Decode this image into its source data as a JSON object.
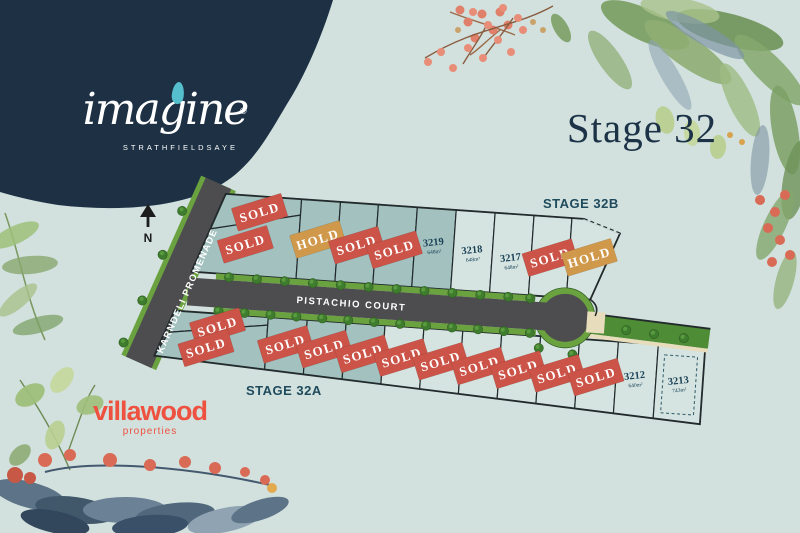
{
  "header": {
    "brand": {
      "name": "imagine",
      "tagline": "STRATHFIELDSAYE",
      "mark": "®"
    },
    "stage_title": "Stage 32"
  },
  "masterplan": {
    "north_label": "N",
    "stage_b_label": "STAGE 32B",
    "stage_a_label": "STAGE 32A",
    "streets": {
      "court": "PISTACHIO COURT",
      "promenade": "KARNDELI  PROMENADE"
    },
    "status_labels": {
      "sold": "SOLD",
      "hold": "HOLD"
    },
    "top_strip": {
      "corner_lots": [
        {
          "status": "sold",
          "tone": "dark"
        },
        {
          "status": "sold",
          "tone": "dark"
        }
      ],
      "lots": [
        {
          "status": "hold",
          "tone": "dark"
        },
        {
          "status": "sold",
          "tone": "dark"
        },
        {
          "status": "sold",
          "tone": "dark"
        },
        {
          "status": "available",
          "number": "3219",
          "area": "648m²",
          "tone": "dark"
        },
        {
          "status": "available",
          "number": "3218",
          "area": "648m²",
          "tone": "light"
        },
        {
          "status": "available",
          "number": "3217",
          "area": "648m²",
          "tone": "light"
        },
        {
          "status": "sold",
          "tone": "light"
        },
        {
          "status": "hold",
          "tone": "light"
        }
      ]
    },
    "bottom_strip": {
      "corner_lots": [
        {
          "status": "sold",
          "tone": "dark"
        },
        {
          "status": "sold",
          "tone": "dark"
        }
      ],
      "lots": [
        {
          "status": "sold",
          "tone": "dark"
        },
        {
          "status": "sold",
          "tone": "dark"
        },
        {
          "status": "sold",
          "tone": "dark"
        },
        {
          "status": "sold",
          "tone": "light"
        },
        {
          "status": "sold",
          "tone": "light"
        },
        {
          "status": "sold",
          "tone": "light"
        },
        {
          "status": "sold",
          "tone": "light"
        },
        {
          "status": "sold",
          "tone": "light"
        },
        {
          "status": "sold",
          "tone": "light"
        },
        {
          "status": "available",
          "number": "3212",
          "area": "640m²",
          "tone": "light"
        },
        {
          "status": "available",
          "number": "3213",
          "area": "743m²",
          "tone": "light",
          "envelope_dashed": true
        }
      ]
    }
  },
  "footer": {
    "developer": {
      "name": "villawood",
      "tagline": "properties"
    }
  },
  "colors": {
    "background": "#d2e1de",
    "navy": "#1d3044",
    "stage_title_text": "#1c3347",
    "stage_label_text": "#1e4a5c",
    "sold_red": "#cb5347",
    "hold_amber": "#d0984a",
    "lot_dark": "#a2c1bf",
    "lot_light": "#d5e4e1",
    "lot_border": "#222a2c",
    "road_asphalt": "#4d4d4f",
    "verge_green": "#6aa23f",
    "reserve_green": "#4e8c35",
    "path_tan": "#e7dcbb",
    "lot_number_text": "#1b4156",
    "villawood_red": "#ee5140",
    "leaf_teal": "#55bfce"
  }
}
